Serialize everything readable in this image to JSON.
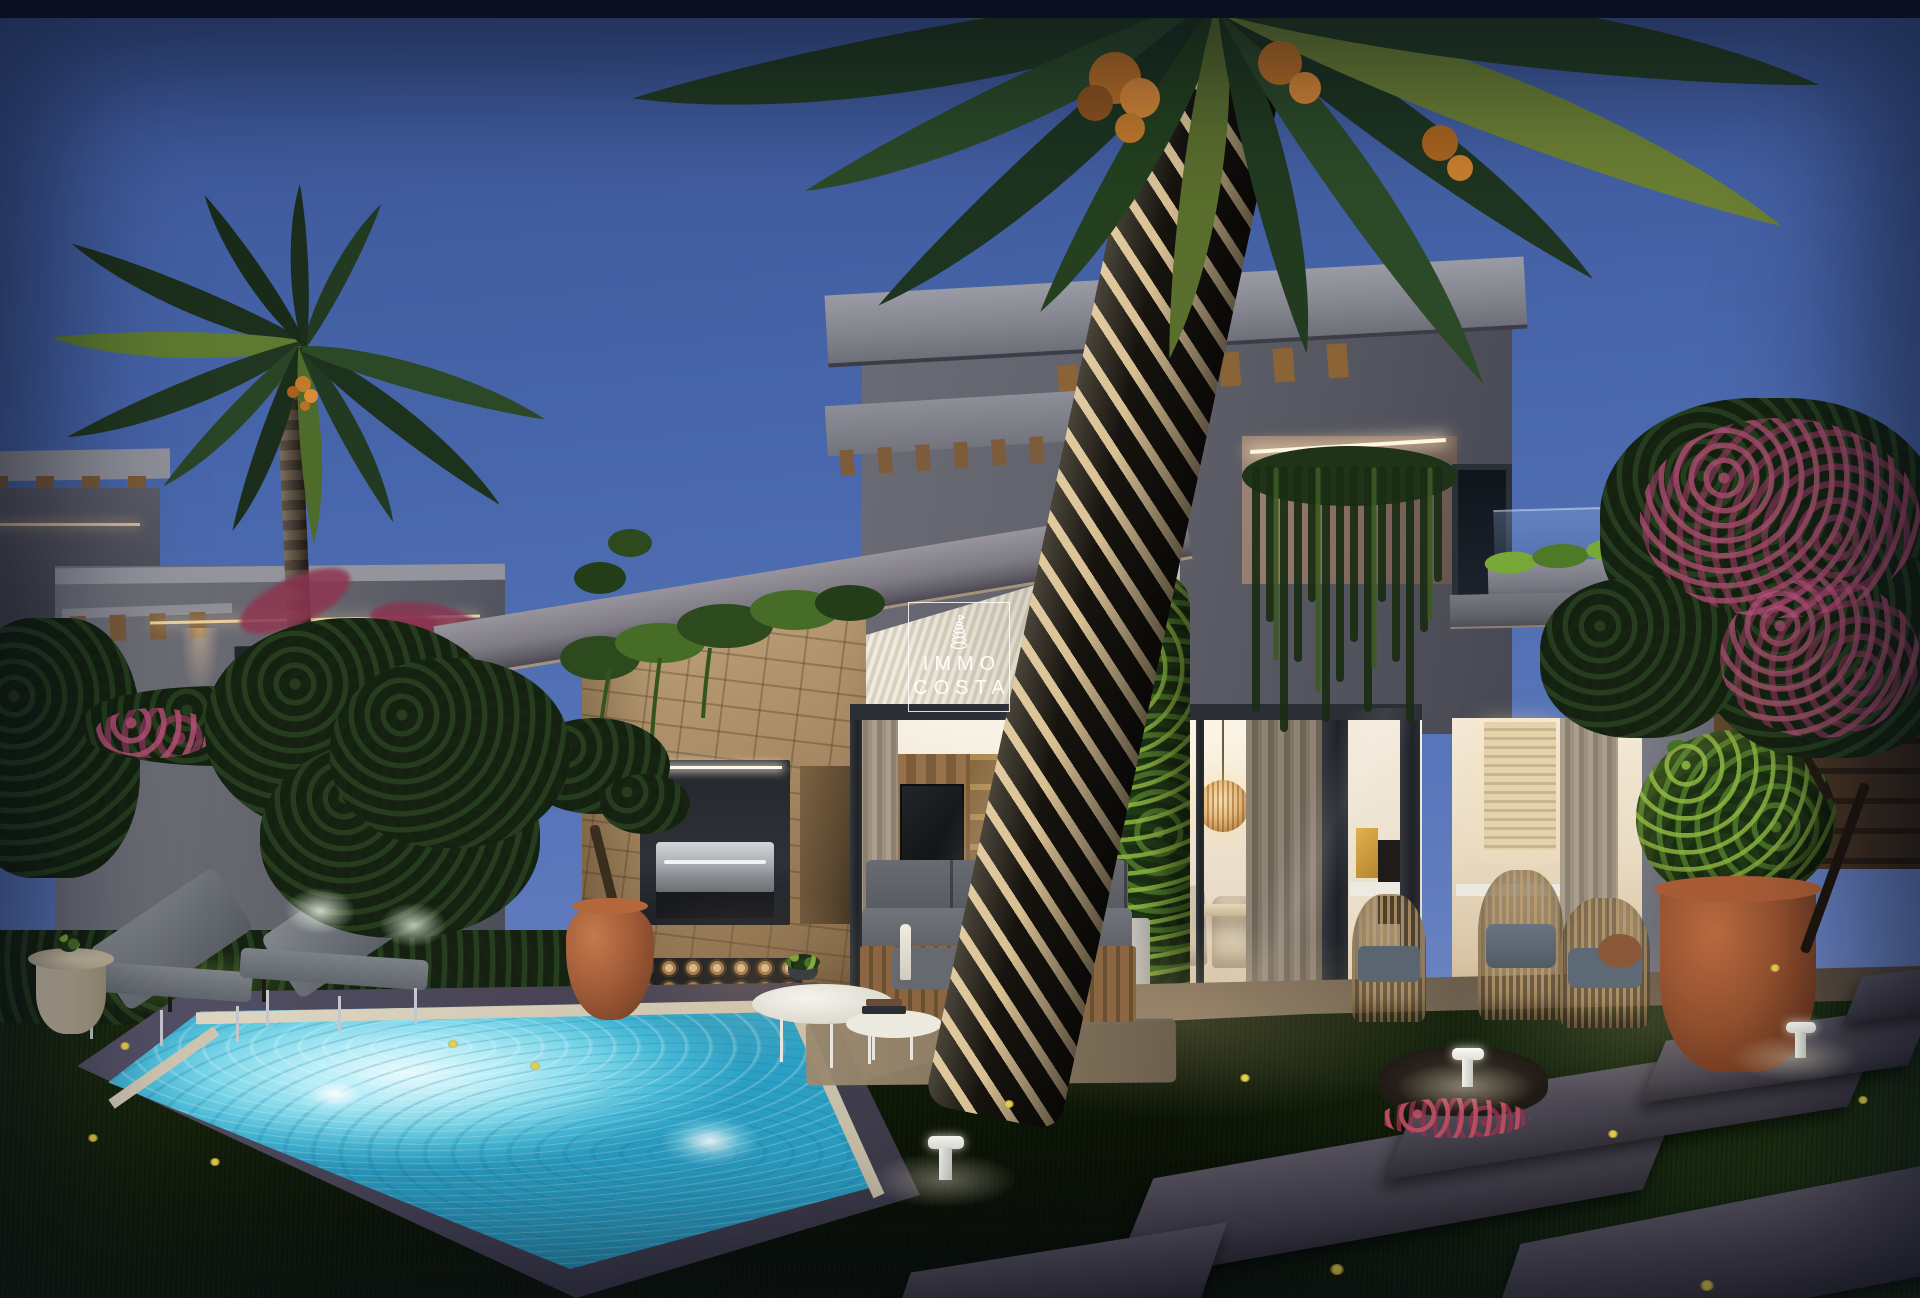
{
  "watermark": {
    "icon": "tower-icon",
    "line1": "IMMO",
    "line2": "COSTA"
  },
  "colors": {
    "sky_top": "#3c5697",
    "sky_horizon": "#7b90c9",
    "concrete": "#60616b",
    "concrete_light": "#9a9ba4",
    "wood_beam": "#8a6336",
    "stone": "#ab8d66",
    "pergola": "#f0ebdd",
    "interior_warm": "#f8f2e7",
    "glass_frame": "#1f2227",
    "pool_bright": "#e8fafd",
    "pool_mid": "#46b8d6",
    "pool_deep": "#2b9fc4",
    "pool_border": "#4a4658",
    "coping": "#cfc6b2",
    "lawn": "#16240d",
    "foliage_dark": "#142010",
    "vine_bright": "#86b23e",
    "hedge": "#203416",
    "terracotta": "#a25c38",
    "pink_bloom": "#8e3550",
    "date_orange": "#c9772b",
    "trunk_light": "#d9c094",
    "trunk_dark": "#17140f",
    "sofa_grey": "#6a6f76",
    "warm_light": "#f2d4a0",
    "curtain": "#8f8375"
  }
}
